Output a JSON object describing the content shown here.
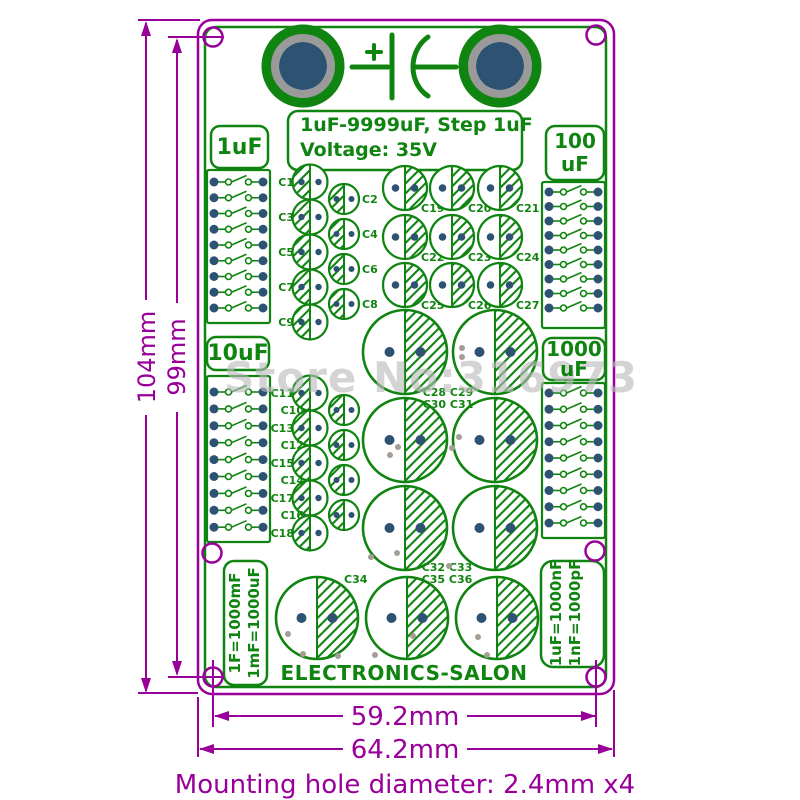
{
  "watermark": "Store No:316973",
  "header": {
    "title_line1": "1uF-9999uF, Step 1uF",
    "title_line2": "Voltage: 35V"
  },
  "section_labels": {
    "top_left": "1uF",
    "top_right_line1": "100",
    "top_right_line2": "uF",
    "mid_left": "10uF",
    "mid_right_line1": "1000",
    "mid_right_line2": "uF"
  },
  "formulas": {
    "left_line1": "1F=1000mF",
    "left_line2": "1mF=1000uF",
    "right_line1": "1uF=1000nF",
    "right_line2": "1nF=1000pF"
  },
  "brand": "ELECTRONICS-SALON",
  "dimensions": {
    "height_outer": "104mm",
    "height_inner": "99mm",
    "width_inner": "59.2mm",
    "width_outer": "64.2mm",
    "caption": "Mounting hole diameter: 2.4mm  x4"
  },
  "colors": {
    "silkscreen": "#108410",
    "dimension": "#990099",
    "pad_blue": "#2e5372",
    "terminal_gray": "#9a9a9a",
    "watermark_gray": "rgba(185,185,185,0.62)"
  },
  "pcb": {
    "switch_blocks": [
      {
        "x": 207,
        "y": 170,
        "h": 153,
        "first": 182,
        "step": 15.75
      },
      {
        "x": 542,
        "y": 182,
        "h": 146,
        "first": 192,
        "step": 14.5
      },
      {
        "x": 207,
        "y": 376,
        "h": 166,
        "first": 392,
        "step": 16.9
      },
      {
        "x": 542,
        "y": 383,
        "h": 155,
        "first": 393,
        "step": 16.25
      }
    ],
    "capacitors": [
      {
        "label": "C1",
        "x": 310,
        "y": 182,
        "r": 17.5,
        "hatch": "left",
        "lx": 294,
        "ly": 186,
        "anchor": "end"
      },
      {
        "label": "C2",
        "x": 344,
        "y": 199,
        "r": 15,
        "hatch": "left",
        "lx": 362,
        "ly": 203,
        "anchor": "start"
      },
      {
        "label": "C3",
        "x": 310,
        "y": 217,
        "r": 17.5,
        "hatch": "left",
        "lx": 294,
        "ly": 221,
        "anchor": "end"
      },
      {
        "label": "C4",
        "x": 344,
        "y": 234,
        "r": 15,
        "hatch": "left",
        "lx": 362,
        "ly": 238,
        "anchor": "start"
      },
      {
        "label": "C5",
        "x": 310,
        "y": 252,
        "r": 17.5,
        "hatch": "left",
        "lx": 294,
        "ly": 256,
        "anchor": "end"
      },
      {
        "label": "C6",
        "x": 344,
        "y": 269,
        "r": 15,
        "hatch": "left",
        "lx": 362,
        "ly": 273,
        "anchor": "start"
      },
      {
        "label": "C7",
        "x": 310,
        "y": 287,
        "r": 17.5,
        "hatch": "left",
        "lx": 294,
        "ly": 291,
        "anchor": "end"
      },
      {
        "label": "C8",
        "x": 344,
        "y": 304,
        "r": 15,
        "hatch": "left",
        "lx": 362,
        "ly": 308,
        "anchor": "start"
      },
      {
        "label": "C9",
        "x": 310,
        "y": 322,
        "r": 17.5,
        "hatch": "left",
        "lx": 294,
        "ly": 326,
        "anchor": "end"
      },
      {
        "label": "C11",
        "x": 310,
        "y": 393,
        "r": 17.5,
        "hatch": "left",
        "lx": 294,
        "ly": 397,
        "anchor": "end"
      },
      {
        "label": "C10",
        "x": 344,
        "y": 410,
        "r": 15,
        "hatch": "left",
        "lx": 304,
        "ly": 414,
        "anchor": "end"
      },
      {
        "label": "C13",
        "x": 310,
        "y": 428,
        "r": 17.5,
        "hatch": "left",
        "lx": 294,
        "ly": 432,
        "anchor": "end"
      },
      {
        "label": "C12",
        "x": 344,
        "y": 445,
        "r": 15,
        "hatch": "left",
        "lx": 304,
        "ly": 449,
        "anchor": "end"
      },
      {
        "label": "C15",
        "x": 310,
        "y": 463,
        "r": 17.5,
        "hatch": "left",
        "lx": 294,
        "ly": 467,
        "anchor": "end"
      },
      {
        "label": "C14",
        "x": 344,
        "y": 480,
        "r": 15,
        "hatch": "left",
        "lx": 304,
        "ly": 484,
        "anchor": "end"
      },
      {
        "label": "C17",
        "x": 310,
        "y": 498,
        "r": 17.5,
        "hatch": "left",
        "lx": 294,
        "ly": 502,
        "anchor": "end"
      },
      {
        "label": "C16",
        "x": 344,
        "y": 515,
        "r": 15,
        "hatch": "left",
        "lx": 304,
        "ly": 519,
        "anchor": "end"
      },
      {
        "label": "C18",
        "x": 310,
        "y": 533,
        "r": 17.5,
        "hatch": "left",
        "lx": 294,
        "ly": 537,
        "anchor": "end"
      },
      {
        "label": "C19",
        "x": 405,
        "y": 188,
        "r": 22,
        "hatch": "right",
        "lx": 421,
        "ly": 212,
        "anchor": "start"
      },
      {
        "label": "C20",
        "x": 452,
        "y": 188,
        "r": 22,
        "hatch": "right",
        "lx": 468,
        "ly": 212,
        "anchor": "start"
      },
      {
        "label": "C21",
        "x": 500,
        "y": 188,
        "r": 22,
        "hatch": "right",
        "lx": 516,
        "ly": 212,
        "anchor": "start"
      },
      {
        "label": "C22",
        "x": 405,
        "y": 237,
        "r": 22,
        "hatch": "right",
        "lx": 421,
        "ly": 261,
        "anchor": "start"
      },
      {
        "label": "C23",
        "x": 452,
        "y": 237,
        "r": 22,
        "hatch": "right",
        "lx": 468,
        "ly": 261,
        "anchor": "start"
      },
      {
        "label": "C24",
        "x": 500,
        "y": 237,
        "r": 22,
        "hatch": "right",
        "lx": 516,
        "ly": 261,
        "anchor": "start"
      },
      {
        "label": "C25",
        "x": 405,
        "y": 285,
        "r": 22,
        "hatch": "right",
        "lx": 421,
        "ly": 309,
        "anchor": "start"
      },
      {
        "label": "C26",
        "x": 452,
        "y": 285,
        "r": 22,
        "hatch": "right",
        "lx": 468,
        "ly": 309,
        "anchor": "start"
      },
      {
        "label": "C27",
        "x": 500,
        "y": 285,
        "r": 22,
        "hatch": "right",
        "lx": 516,
        "ly": 309,
        "anchor": "start"
      },
      {
        "label": "C28",
        "x": 405,
        "y": 352,
        "r": 42,
        "hatch": "right"
      },
      {
        "label": "C29",
        "x": 495,
        "y": 352,
        "r": 42,
        "hatch": "right"
      },
      {
        "label": "C30",
        "x": 405,
        "y": 440,
        "r": 42,
        "hatch": "right"
      },
      {
        "label": "C31",
        "x": 495,
        "y": 440,
        "r": 42,
        "hatch": "right"
      },
      {
        "label": "C32",
        "x": 405,
        "y": 528,
        "r": 42,
        "hatch": "right"
      },
      {
        "label": "C33",
        "x": 495,
        "y": 528,
        "r": 42,
        "hatch": "right"
      },
      {
        "label": "C34",
        "x": 317,
        "y": 618,
        "r": 41,
        "hatch": "right"
      },
      {
        "label": "C35",
        "x": 407,
        "y": 618,
        "r": 41,
        "hatch": "right"
      },
      {
        "label": "C36",
        "x": 497,
        "y": 618,
        "r": 41,
        "hatch": "right"
      }
    ],
    "group_labels": [
      {
        "text": "C28 C29",
        "x": 448,
        "y": 396,
        "anchor": "middle"
      },
      {
        "text": "C30 C31",
        "x": 448,
        "y": 408,
        "anchor": "middle"
      },
      {
        "text": "C32 C33",
        "x": 447,
        "y": 571,
        "anchor": "middle"
      },
      {
        "text": "C35 C36",
        "x": 447,
        "y": 583,
        "anchor": "middle"
      },
      {
        "text": "C34",
        "x": 344,
        "y": 583,
        "anchor": "start"
      }
    ],
    "extra_pads": [
      [
        462,
        348
      ],
      [
        462,
        357
      ],
      [
        459,
        437
      ],
      [
        452,
        448
      ],
      [
        398,
        447
      ],
      [
        390,
        455
      ],
      [
        371,
        557
      ],
      [
        397,
        553
      ],
      [
        449,
        566
      ],
      [
        288,
        634
      ],
      [
        303,
        654
      ],
      [
        338,
        656
      ],
      [
        375,
        655
      ],
      [
        413,
        636
      ],
      [
        478,
        637
      ],
      [
        487,
        655
      ]
    ],
    "mount_holes": [
      [
        213,
        37
      ],
      [
        596,
        35
      ],
      [
        212,
        553
      ],
      [
        595,
        551
      ],
      [
        213,
        677
      ],
      [
        596,
        677
      ]
    ]
  }
}
